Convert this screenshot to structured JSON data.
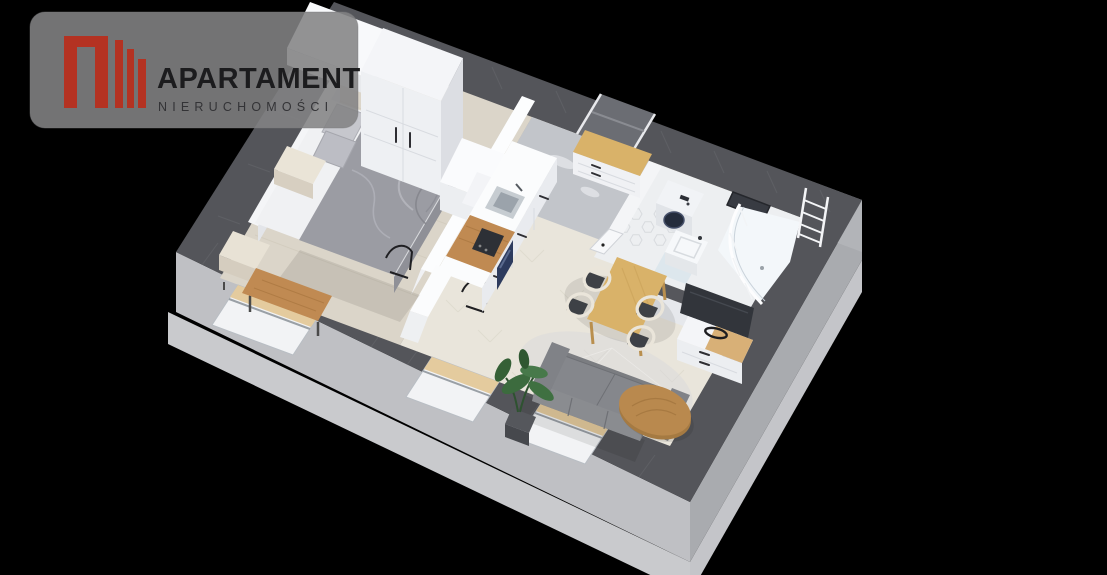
{
  "logo": {
    "title": "APARTAMENT",
    "subtitle": "NIERUCHOMOŚCI",
    "icon": "buildings-logo-icon",
    "panel_color": "#838384",
    "accent_red": "#b43222",
    "title_color": "#1c1c1e",
    "subtitle_color": "#333336"
  },
  "scene": {
    "type": "3d-isometric-floor-plan",
    "description": "Top-down 3D cutaway render of a furnished studio apartment on a black background",
    "rooms": [
      {
        "name": "bedroom",
        "floor": "pale wood planks",
        "items": [
          "double bed with gray bedding",
          "white headboard",
          "two gray pillows",
          "cream nightstand",
          "second cream nightstand",
          "wooden window bench",
          "two black metal chairs",
          "white wardrobe",
          "tall white double-door wardrobe"
        ]
      },
      {
        "name": "kitchen",
        "floor": "light herringbone parquet",
        "items": [
          "tall white cabinet block",
          "white counter run",
          "stainless steel sink with faucet",
          "wooden worktop with dark cooktop",
          "navy oven front",
          "white cabinet fronts with handles"
        ]
      },
      {
        "name": "hallway",
        "floor": "gray marble",
        "items": [
          "entry door in top wall",
          "white shoe cabinet with wooden top"
        ]
      },
      {
        "name": "bathroom",
        "floor": "white hexagonal tiles",
        "items": [
          "washing machine with dark round door",
          "white washbasin",
          "curved glass shower enclosure",
          "white towel ladder",
          "dark wall mirror"
        ]
      },
      {
        "name": "living-dining",
        "floor": "light herringbone parquet",
        "items": [
          "light oak dining table",
          "four chairs with cream frames and dark seats",
          "white TV cabinet with wooden top",
          "flat TV leaning on partition",
          "gray sofa",
          "organic-shaped wooden coffee table",
          "round light rug",
          "potted monstera plant"
        ]
      }
    ],
    "window_count": 3,
    "colors": {
      "background": "#000000",
      "wall_top": "#54555a",
      "wall_face_light": "#bfc0c4",
      "wall_face_shade": "#a9abaf",
      "slab": "#c9cacd",
      "floor_bedroom": "#dbd5c9",
      "floor_living": "#e9e5db",
      "floor_hallway": "#c2c5ca",
      "floor_bathroom": "#edeff1",
      "furniture_white": "#f4f5f8",
      "wood_table": "#d9b269",
      "wood_counter": "#c08a52",
      "wood_coffee": "#b9894e",
      "wood_sill": "#e4cb9e",
      "sofa": "#7b7d81",
      "duvet": "#9b9ca3",
      "plant": "#3c6b3e",
      "tv": "#32353b",
      "washer_door": "#242c3c",
      "shower_glass": "#f3f7fa"
    }
  }
}
